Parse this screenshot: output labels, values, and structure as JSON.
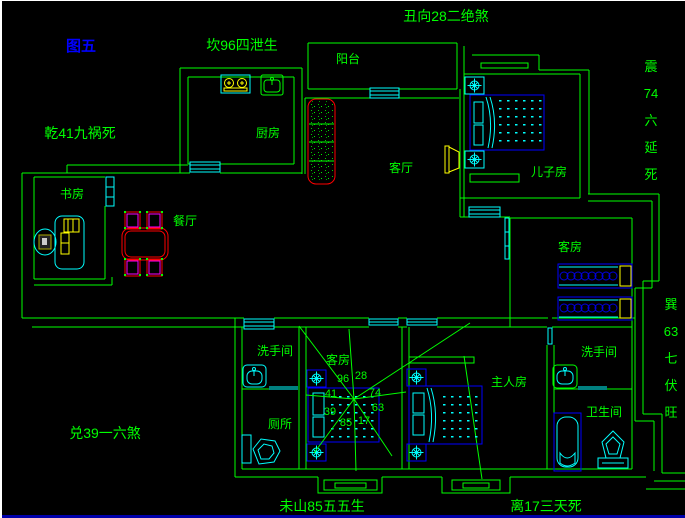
{
  "title": {
    "figure_label": "图五"
  },
  "perimeter": {
    "top_left": "坎96四泄生",
    "top": "丑向28二绝煞",
    "left": "乾41九祸死",
    "bottom_left": "兑39一六煞",
    "bottom_center": "未山85五五生",
    "bottom_right": "离17三天死",
    "right_top": "震74六延死",
    "right_bottom": "巽63七伏旺"
  },
  "rooms": {
    "balcony": "阳台",
    "kitchen": "厨房",
    "living_room": "客厅",
    "sons_room": "儿子房",
    "study": "书房",
    "dining_room": "餐厅",
    "guest_room_right": "客房",
    "guest_room_center": "客房",
    "washroom_left": "洗手间",
    "toilet_room": "厕所",
    "master_bedroom": "主人房",
    "washroom_right": "洗手间",
    "bathroom": "卫生间"
  },
  "compass": {
    "numbers": [
      "96",
      "28",
      "41",
      "74",
      "39",
      "63",
      "85",
      "17"
    ]
  },
  "colors": {
    "background": "#000000",
    "wall_green": "#00ff00",
    "fixture_cyan": "#00ffff",
    "furniture_blue": "#0000ff",
    "accent_red": "#ff0000",
    "accent_magenta": "#ff00ff",
    "accent_yellow": "#ffff00",
    "figure_label_blue": "#0000ff"
  }
}
